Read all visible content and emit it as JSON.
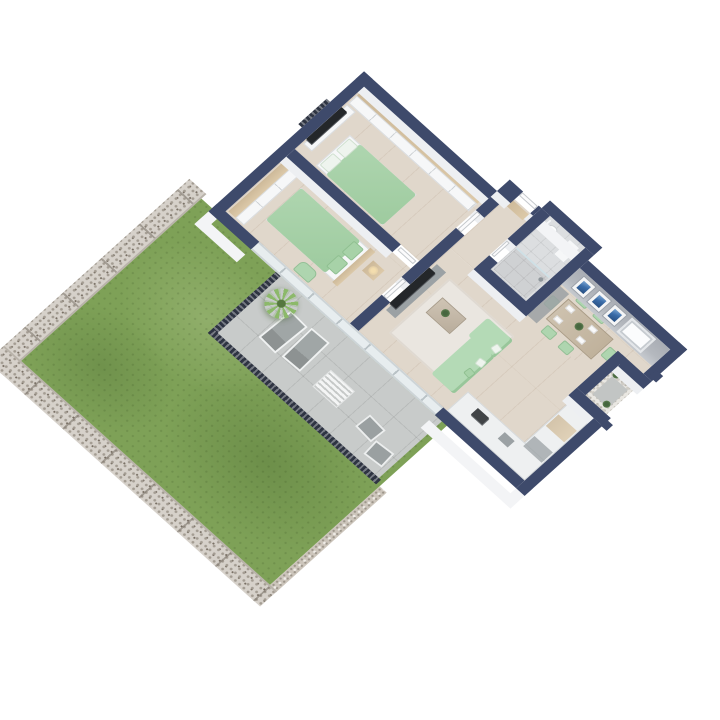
{
  "scene": {
    "kind": "3d-isometric-floor-plan-render",
    "background": "#ffffff",
    "rotation_deg": 45
  },
  "colors": {
    "bg": "#ffffff",
    "wall": "#3e4a6b",
    "wallface": "#edeff2",
    "wallfacetall": "#f3f4f6",
    "wood": "#e0d7cb",
    "wood2": "#cdb999",
    "tile": "#c8cbca",
    "bath": "#dcdee0",
    "grass": "#7ea157",
    "gabion": "#d6d1ca",
    "gravel": "#ccc5bb",
    "mint": "#aed5af",
    "sofagreen": "#b4dab6",
    "tv": "#24272a",
    "rail": "#2e3442",
    "glass": "#e7edef",
    "grayface": "#b4b8be",
    "art": "#3a6ca8",
    "counter": "#eef0f1",
    "cgray": "#9ba1a4",
    "lounge": "#a0a6a6",
    "rug": "#eae6e0",
    "pebble": "#e9e7e2",
    "mat": "#c2c5c4",
    "plant": "#46663f",
    "palm": "#8cb96a",
    "lamp": "#f3ddae"
  },
  "rooms": [
    {
      "id": "bedroom-1",
      "floor": "wood",
      "items": [
        "wardrobe",
        "double-bed",
        "dresser",
        "tv",
        "juliet-window"
      ]
    },
    {
      "id": "bedroom-2",
      "floor": "wood",
      "items": [
        "wardrobe",
        "double-bed",
        "headboard",
        "nightstand",
        "lamp",
        "armchair"
      ]
    },
    {
      "id": "hallway",
      "floor": "wood",
      "items": [
        "console",
        "entrance-door"
      ]
    },
    {
      "id": "bathroom",
      "floor": "tile",
      "items": [
        "toilet",
        "washbasin",
        "shower"
      ]
    },
    {
      "id": "dining-area",
      "floor": "wood",
      "items": [
        "dining-table",
        "place-settings",
        "centerpiece-plant"
      ],
      "chairs": 6,
      "artworks": 3,
      "windows": 1
    },
    {
      "id": "kitchen",
      "floor": "wood",
      "items": [
        "l-shaped-counter",
        "tall-cabinet",
        "hob",
        "sink"
      ]
    },
    {
      "id": "living-room",
      "floor": "wood",
      "items": [
        "tv-console",
        "tv",
        "coffee-table",
        "rug",
        "corner-sofa",
        "sofa-pillows"
      ]
    },
    {
      "id": "loggia-nook",
      "floor": "pebble",
      "items": [
        "pebble-wall",
        "gray-mat",
        "plants"
      ]
    }
  ],
  "outdoor": {
    "terrace": {
      "floor": "tile",
      "items": [
        "palm-plant",
        "lounger",
        "lounger",
        "slatted-table",
        "outdoor-chair",
        "outdoor-chair",
        "railing-west",
        "railing-south",
        "sliding-glass-doors"
      ]
    },
    "garden": {
      "lawn": "grass",
      "boundaries": [
        "gabion-wall-left",
        "gabion-wall-bottom",
        "gravel-border"
      ]
    }
  }
}
